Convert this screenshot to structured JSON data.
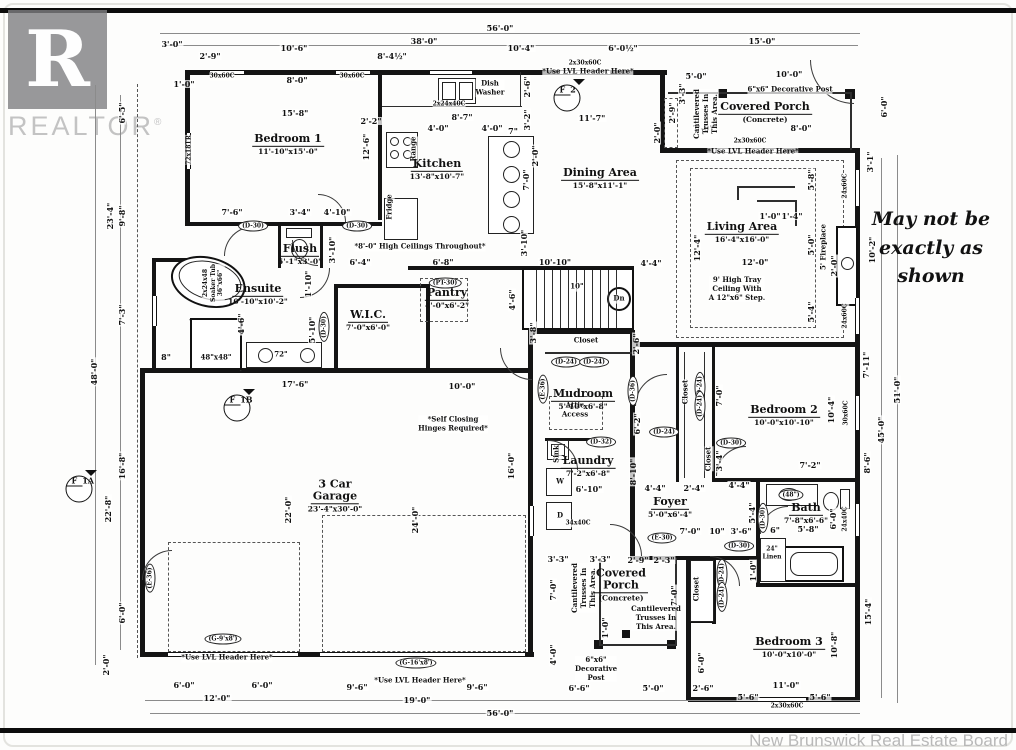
{
  "page": {
    "brand_letter": "R",
    "brand": "REALTOR",
    "brand_reg": "®",
    "disclaimer_lines": [
      "May not be",
      "exactly as",
      "shown"
    ],
    "footer": "New Brunswick Real Estate Board"
  },
  "rooms": [
    {
      "n": "Bedroom 1",
      "s": "11'-10\"x15'-0\"",
      "x": 288,
      "y": 142
    },
    {
      "n": "Kitchen",
      "s": "13'-8\"x10'-7\"",
      "x": 437,
      "y": 167
    },
    {
      "n": "Dining Area",
      "s": "15'-8\"x11'-1\"",
      "x": 600,
      "y": 176
    },
    {
      "n": "Covered Porch",
      "s": "(Concrete)",
      "x": 765,
      "y": 110
    },
    {
      "n": "Living Area",
      "s": "16'-4\"x16'-0\"",
      "x": 742,
      "y": 230
    },
    {
      "n": "Ensuite",
      "s": "10'-10\"x10'-2\"",
      "x": 258,
      "y": 292
    },
    {
      "n": "Flush",
      "s": "5'-1\"x3'-0\"",
      "x": 300,
      "y": 252
    },
    {
      "n": "W.I.C.",
      "s": "7'-0\"x6'-0\"",
      "x": 368,
      "y": 318
    },
    {
      "n": "Pantry",
      "s": "4'-0\"x6'-2\"",
      "x": 447,
      "y": 296
    },
    {
      "n": "Mudroom",
      "s": "5'-10\"x6'-8\"",
      "x": 583,
      "y": 397
    },
    {
      "n": "Laundry",
      "s": "7'-2\"x6'-8\"",
      "x": 588,
      "y": 464
    },
    {
      "n": "Foyer",
      "s": "5'-0\"x6'-4\"",
      "x": 670,
      "y": 505
    },
    {
      "n": "Bedroom 2",
      "s": "10'-0\"x10'-10\"",
      "x": 784,
      "y": 413
    },
    {
      "n": "Bath",
      "s": "7'-8\"x6'-6\"",
      "x": 806,
      "y": 511
    },
    {
      "n": "3 Car\nGarage",
      "s": "23'-4\"x30'-0\"",
      "x": 335,
      "y": 496
    },
    {
      "n": "Covered\nPorch",
      "s": "(Concrete)",
      "x": 621,
      "y": 585
    },
    {
      "n": "Bedroom 3",
      "s": "10'-0\"x10'-0\"",
      "x": 789,
      "y": 645
    }
  ],
  "dims": [
    {
      "t": "56'-0\"",
      "x": 500,
      "y": 28
    },
    {
      "t": "3'-0\"",
      "x": 172,
      "y": 44
    },
    {
      "t": "2'-9\"",
      "x": 210,
      "y": 56
    },
    {
      "t": "10'-6\"",
      "x": 294,
      "y": 48
    },
    {
      "t": "8'-4½\"",
      "x": 392,
      "y": 56
    },
    {
      "t": "38'-0\"",
      "x": 424,
      "y": 41
    },
    {
      "t": "10'-4\"",
      "x": 521,
      "y": 48
    },
    {
      "t": "6'-0½\"",
      "x": 623,
      "y": 48
    },
    {
      "t": "15'-0\"",
      "x": 762,
      "y": 41
    },
    {
      "t": "1'-0\"",
      "x": 184,
      "y": 84
    },
    {
      "t": "8'-0\"",
      "x": 297,
      "y": 80
    },
    {
      "t": "15'-8\"",
      "x": 295,
      "y": 113
    },
    {
      "t": "2'-2\"",
      "x": 371,
      "y": 121
    },
    {
      "t": "8'-7\"",
      "x": 462,
      "y": 117
    },
    {
      "t": "4'-0\"",
      "x": 438,
      "y": 128
    },
    {
      "t": "4'-0\"",
      "x": 492,
      "y": 128
    },
    {
      "t": "7\"",
      "x": 513,
      "y": 131
    },
    {
      "t": "11'-7\"",
      "x": 592,
      "y": 118
    },
    {
      "t": "5'-0\"",
      "x": 696,
      "y": 76
    },
    {
      "t": "10'-0\"",
      "x": 789,
      "y": 74
    },
    {
      "t": "7'-0\"",
      "x": 703,
      "y": 128
    },
    {
      "t": "8'-0\"",
      "x": 801,
      "y": 128
    },
    {
      "t": "2'-9\"",
      "x": 672,
      "y": 113,
      "v": 1
    },
    {
      "t": "3'-3\"",
      "x": 682,
      "y": 94,
      "v": 1
    },
    {
      "t": "2'-0\"",
      "x": 657,
      "y": 133,
      "v": 1
    },
    {
      "t": "2'-6\"",
      "x": 527,
      "y": 87,
      "v": 1
    },
    {
      "t": "3'-2\"",
      "x": 527,
      "y": 120,
      "v": 1
    },
    {
      "t": "12'-6\"",
      "x": 366,
      "y": 147,
      "v": 1
    },
    {
      "t": "6'-0\"",
      "x": 884,
      "y": 107,
      "v": 1
    },
    {
      "t": "3'-1\"",
      "x": 870,
      "y": 162,
      "v": 1
    },
    {
      "t": "10'-2\"",
      "x": 872,
      "y": 250,
      "v": 1
    },
    {
      "t": "5'-8\"",
      "x": 811,
      "y": 180,
      "v": 1
    },
    {
      "t": "5'-0\"",
      "x": 811,
      "y": 245,
      "v": 1
    },
    {
      "t": "5'-4\"",
      "x": 811,
      "y": 312,
      "v": 1
    },
    {
      "t": "1'-0\"",
      "x": 770,
      "y": 216
    },
    {
      "t": "1'-4\"",
      "x": 792,
      "y": 216
    },
    {
      "t": "2'-0\"",
      "x": 834,
      "y": 266,
      "v": 1
    },
    {
      "t": "12'-4\"",
      "x": 697,
      "y": 248,
      "v": 1
    },
    {
      "t": "12'-0\"",
      "x": 755,
      "y": 262
    },
    {
      "t": "7'-0\"",
      "x": 526,
      "y": 180,
      "v": 1
    },
    {
      "t": "3'-10\"",
      "x": 524,
      "y": 243,
      "v": 1
    },
    {
      "t": "2'-0\"",
      "x": 535,
      "y": 156,
      "v": 1
    },
    {
      "t": "3'-8\"",
      "x": 533,
      "y": 333,
      "v": 1
    },
    {
      "t": "7'-6\"",
      "x": 232,
      "y": 212
    },
    {
      "t": "3'-4\"",
      "x": 300,
      "y": 212
    },
    {
      "t": "4'-10\"",
      "x": 337,
      "y": 212
    },
    {
      "t": "3'-10\"",
      "x": 332,
      "y": 250,
      "v": 1
    },
    {
      "t": "1'-10\"",
      "x": 308,
      "y": 284,
      "v": 1
    },
    {
      "t": "5'-10\"",
      "x": 312,
      "y": 330,
      "v": 1
    },
    {
      "t": "6'-4\"",
      "x": 360,
      "y": 262
    },
    {
      "t": "6'-8\"",
      "x": 443,
      "y": 262
    },
    {
      "t": "10'-10\"",
      "x": 555,
      "y": 262
    },
    {
      "t": "4'-4\"",
      "x": 651,
      "y": 263
    },
    {
      "t": "4'-6\"",
      "x": 512,
      "y": 300,
      "v": 1
    },
    {
      "t": "4'-6\"",
      "x": 241,
      "y": 324,
      "v": 1
    },
    {
      "t": "17'-6\"",
      "x": 295,
      "y": 384
    },
    {
      "t": "10'-0\"",
      "x": 462,
      "y": 386
    },
    {
      "t": "8\"",
      "x": 166,
      "y": 357
    },
    {
      "t": "22'-0\"",
      "x": 288,
      "y": 510,
      "v": 1
    },
    {
      "t": "24'-0\"",
      "x": 415,
      "y": 520,
      "v": 1
    },
    {
      "t": "16'-0\"",
      "x": 511,
      "y": 466,
      "v": 1
    },
    {
      "t": "2'-6\"",
      "x": 636,
      "y": 344,
      "v": 1
    },
    {
      "t": "6'-2\"",
      "x": 637,
      "y": 424,
      "v": 1
    },
    {
      "t": "8'-10\"",
      "x": 633,
      "y": 472,
      "v": 1
    },
    {
      "t": "6'-10\"",
      "x": 589,
      "y": 489
    },
    {
      "t": "4'-4\"",
      "x": 655,
      "y": 488
    },
    {
      "t": "2'-4\"",
      "x": 694,
      "y": 488
    },
    {
      "t": "4'-4\"",
      "x": 739,
      "y": 485
    },
    {
      "t": "7'-0\"",
      "x": 690,
      "y": 531
    },
    {
      "t": "10\"",
      "x": 717,
      "y": 531
    },
    {
      "t": "3'-6\"",
      "x": 741,
      "y": 531
    },
    {
      "t": "6\"",
      "x": 775,
      "y": 530
    },
    {
      "t": "5'-4\"",
      "x": 752,
      "y": 513,
      "v": 1
    },
    {
      "t": "5'-8\"",
      "x": 808,
      "y": 529
    },
    {
      "t": "1'-0\"",
      "x": 753,
      "y": 571,
      "v": 1
    },
    {
      "t": "7'-2\"",
      "x": 810,
      "y": 465
    },
    {
      "t": "3'-4\"",
      "x": 719,
      "y": 461,
      "v": 1
    },
    {
      "t": "7'-0\"",
      "x": 719,
      "y": 396,
      "v": 1
    },
    {
      "t": "10'-4\"",
      "x": 831,
      "y": 410,
      "v": 1
    },
    {
      "t": "6'-0\"",
      "x": 833,
      "y": 519,
      "v": 1
    },
    {
      "t": "8'-6\"",
      "x": 867,
      "y": 463,
      "v": 1
    },
    {
      "t": "7'-11\"",
      "x": 866,
      "y": 365,
      "v": 1
    },
    {
      "t": "45'-0\"",
      "x": 881,
      "y": 430,
      "v": 1
    },
    {
      "t": "51'-0\"",
      "x": 897,
      "y": 390,
      "v": 1
    },
    {
      "t": "15'-4\"",
      "x": 868,
      "y": 612,
      "v": 1
    },
    {
      "t": "10'-8\"",
      "x": 834,
      "y": 645,
      "v": 1
    },
    {
      "t": "11'-0\"",
      "x": 786,
      "y": 685
    },
    {
      "t": "5'-6\"",
      "x": 748,
      "y": 697
    },
    {
      "t": "5'-6\"",
      "x": 820,
      "y": 697
    },
    {
      "t": "6'-5\"",
      "x": 122,
      "y": 113,
      "v": 1
    },
    {
      "t": "23'-4\"",
      "x": 110,
      "y": 216,
      "v": 1
    },
    {
      "t": "9'-8\"",
      "x": 122,
      "y": 216,
      "v": 1
    },
    {
      "t": "7'-3\"",
      "x": 122,
      "y": 315,
      "v": 1
    },
    {
      "t": "48'-0\"",
      "x": 94,
      "y": 372,
      "v": 1
    },
    {
      "t": "16'-8\"",
      "x": 122,
      "y": 466,
      "v": 1
    },
    {
      "t": "22'-8\"",
      "x": 108,
      "y": 509,
      "v": 1
    },
    {
      "t": "6'-0\"",
      "x": 122,
      "y": 613,
      "v": 1
    },
    {
      "t": "2'-0\"",
      "x": 106,
      "y": 665,
      "v": 1
    },
    {
      "t": "3'-3\"",
      "x": 558,
      "y": 559
    },
    {
      "t": "3'-3\"",
      "x": 600,
      "y": 559
    },
    {
      "t": "2'-9\"",
      "x": 638,
      "y": 560
    },
    {
      "t": "2'-3\"",
      "x": 664,
      "y": 560
    },
    {
      "t": "7'-0\"",
      "x": 553,
      "y": 590,
      "v": 1
    },
    {
      "t": "7'-0\"",
      "x": 674,
      "y": 596,
      "v": 1
    },
    {
      "t": "4'-0\"",
      "x": 553,
      "y": 655,
      "v": 1
    },
    {
      "t": "1'-0\"",
      "x": 605,
      "y": 628,
      "v": 1
    },
    {
      "t": "6'-6\"",
      "x": 579,
      "y": 688
    },
    {
      "t": "5'-0\"",
      "x": 653,
      "y": 688
    },
    {
      "t": "2'-6\"",
      "x": 703,
      "y": 688
    },
    {
      "t": "6'-0\"",
      "x": 701,
      "y": 663,
      "v": 1
    },
    {
      "t": "6'-0\"",
      "x": 184,
      "y": 685
    },
    {
      "t": "6'-0\"",
      "x": 262,
      "y": 685
    },
    {
      "t": "12'-0\"",
      "x": 217,
      "y": 698
    },
    {
      "t": "9'-6\"",
      "x": 357,
      "y": 687
    },
    {
      "t": "9'-6\"",
      "x": 477,
      "y": 687
    },
    {
      "t": "19'-0\"",
      "x": 417,
      "y": 700
    },
    {
      "t": "56'-0\"",
      "x": 500,
      "y": 713
    }
  ],
  "notes": [
    {
      "t": "2x30x60C",
      "x": 585,
      "y": 63,
      "f": 6
    },
    {
      "t": "*Use LVL Header Here*",
      "x": 588,
      "y": 72
    },
    {
      "t": "30x60C",
      "x": 222,
      "y": 76,
      "f": 6
    },
    {
      "t": "30x60C",
      "x": 352,
      "y": 76,
      "f": 6
    },
    {
      "t": "2x24x40C",
      "x": 449,
      "y": 104,
      "f": 6
    },
    {
      "t": "Dish\nWasher",
      "x": 490,
      "y": 88
    },
    {
      "t": "Range",
      "x": 414,
      "y": 149,
      "v": 1
    },
    {
      "t": "Fridge",
      "x": 390,
      "y": 207,
      "v": 1
    },
    {
      "t": "72x18TR",
      "x": 189,
      "y": 150,
      "v": 1,
      "f": 6
    },
    {
      "t": "2x30x60C",
      "x": 750,
      "y": 141,
      "f": 6
    },
    {
      "t": "*Use LVL Header Here*",
      "x": 753,
      "y": 152
    },
    {
      "t": "6\"x6\" Decorative Post",
      "x": 790,
      "y": 90
    },
    {
      "t": "Cantilevered\nTrusses In\nThis Area.",
      "x": 706,
      "y": 114,
      "v": 1
    },
    {
      "t": "24x60C",
      "x": 845,
      "y": 186,
      "v": 1,
      "f": 6
    },
    {
      "t": "24x60C",
      "x": 845,
      "y": 316,
      "v": 1,
      "f": 6
    },
    {
      "t": "5' Fireplace",
      "x": 824,
      "y": 247,
      "v": 1
    },
    {
      "t": "9' High Tray\nCeiling With\nA 12\"x6\" Step.",
      "x": 737,
      "y": 289
    },
    {
      "t": "*8'-0\" High Ceilings Throughout*",
      "x": 420,
      "y": 247
    },
    {
      "t": "Closet",
      "x": 586,
      "y": 341
    },
    {
      "t": "Attic\nAccess",
      "x": 575,
      "y": 410
    },
    {
      "t": "*Self Closing\nHinges Required*",
      "x": 453,
      "y": 424
    },
    {
      "t": "Sink",
      "x": 557,
      "y": 454,
      "v": 1
    },
    {
      "t": "W",
      "x": 560,
      "y": 482
    },
    {
      "t": "D",
      "x": 560,
      "y": 516
    },
    {
      "t": "34x40C",
      "x": 578,
      "y": 523,
      "f": 6
    },
    {
      "t": "30x60C",
      "x": 846,
      "y": 413,
      "v": 1,
      "f": 6
    },
    {
      "t": "Closet",
      "x": 686,
      "y": 392,
      "v": 1
    },
    {
      "t": "Closet",
      "x": 709,
      "y": 459,
      "v": 1
    },
    {
      "t": "24\"\nLinen",
      "x": 772,
      "y": 553,
      "f": 6
    },
    {
      "t": "24x40C",
      "x": 845,
      "y": 519,
      "v": 1,
      "f": 6
    },
    {
      "t": "Dn",
      "x": 619,
      "y": 299
    },
    {
      "t": "10\"",
      "x": 577,
      "y": 287
    },
    {
      "t": "Cantilevered\nTrusses In\nThis Area.",
      "x": 584,
      "y": 588,
      "v": 1
    },
    {
      "t": "Cantilevered\nTrusses In\nThis Area.",
      "x": 656,
      "y": 618
    },
    {
      "t": "6\"x6\"\nDecorative\nPost",
      "x": 596,
      "y": 669
    },
    {
      "t": "*Use LVL Header Here*",
      "x": 227,
      "y": 658
    },
    {
      "t": "*Use LVL Header Here*",
      "x": 420,
      "y": 681
    },
    {
      "t": "2x30x60C",
      "x": 787,
      "y": 706,
      "f": 6
    },
    {
      "t": "Closet",
      "x": 697,
      "y": 589,
      "v": 1
    },
    {
      "t": "48\"x48\"",
      "x": 216,
      "y": 358
    },
    {
      "t": "72\"",
      "x": 281,
      "y": 355
    },
    {
      "t": "2x24x48\nSoaker Tub\n36\"x66\"",
      "x": 213,
      "y": 283,
      "v": 1,
      "f": 6
    }
  ],
  "door_tags": [
    {
      "t": "(D-30)",
      "x": 253,
      "y": 226
    },
    {
      "t": "(D-30)",
      "x": 357,
      "y": 226
    },
    {
      "t": "(D-30)",
      "x": 324,
      "y": 327,
      "v": 1
    },
    {
      "t": "(PT-30)",
      "x": 445,
      "y": 283
    },
    {
      "t": "(D-24)",
      "x": 566,
      "y": 362
    },
    {
      "t": "(D-24)",
      "x": 594,
      "y": 362
    },
    {
      "t": "(E-36)",
      "x": 543,
      "y": 389,
      "v": 1
    },
    {
      "t": "(D-36)",
      "x": 633,
      "y": 391,
      "v": 1
    },
    {
      "t": "(D-32)",
      "x": 601,
      "y": 442
    },
    {
      "t": "(D-24)",
      "x": 700,
      "y": 387,
      "v": 1
    },
    {
      "t": "(D-24)",
      "x": 700,
      "y": 406,
      "v": 1
    },
    {
      "t": "(D-24)",
      "x": 664,
      "y": 432
    },
    {
      "t": "(D-30)",
      "x": 731,
      "y": 443
    },
    {
      "t": "(E-30)",
      "x": 662,
      "y": 538
    },
    {
      "t": "(D-30)",
      "x": 763,
      "y": 518,
      "v": 1
    },
    {
      "t": "(D-30)",
      "x": 739,
      "y": 546
    },
    {
      "t": "(D-24)",
      "x": 722,
      "y": 574,
      "v": 1
    },
    {
      "t": "(D-24)",
      "x": 722,
      "y": 597,
      "v": 1
    },
    {
      "t": "(E-36)",
      "x": 150,
      "y": 578,
      "v": 1
    },
    {
      "t": "(G-9'x8')",
      "x": 223,
      "y": 639
    },
    {
      "t": "(G-16'x8')",
      "x": 416,
      "y": 663
    },
    {
      "t": "(48\")",
      "x": 791,
      "y": 495
    }
  ],
  "markers": [
    {
      "top": "F",
      "bot": "2",
      "x": 567,
      "y": 98
    },
    {
      "top": "F",
      "bot": "1B",
      "x": 237,
      "y": 408
    },
    {
      "top": "F",
      "bot": "1A",
      "x": 79,
      "y": 489
    }
  ]
}
